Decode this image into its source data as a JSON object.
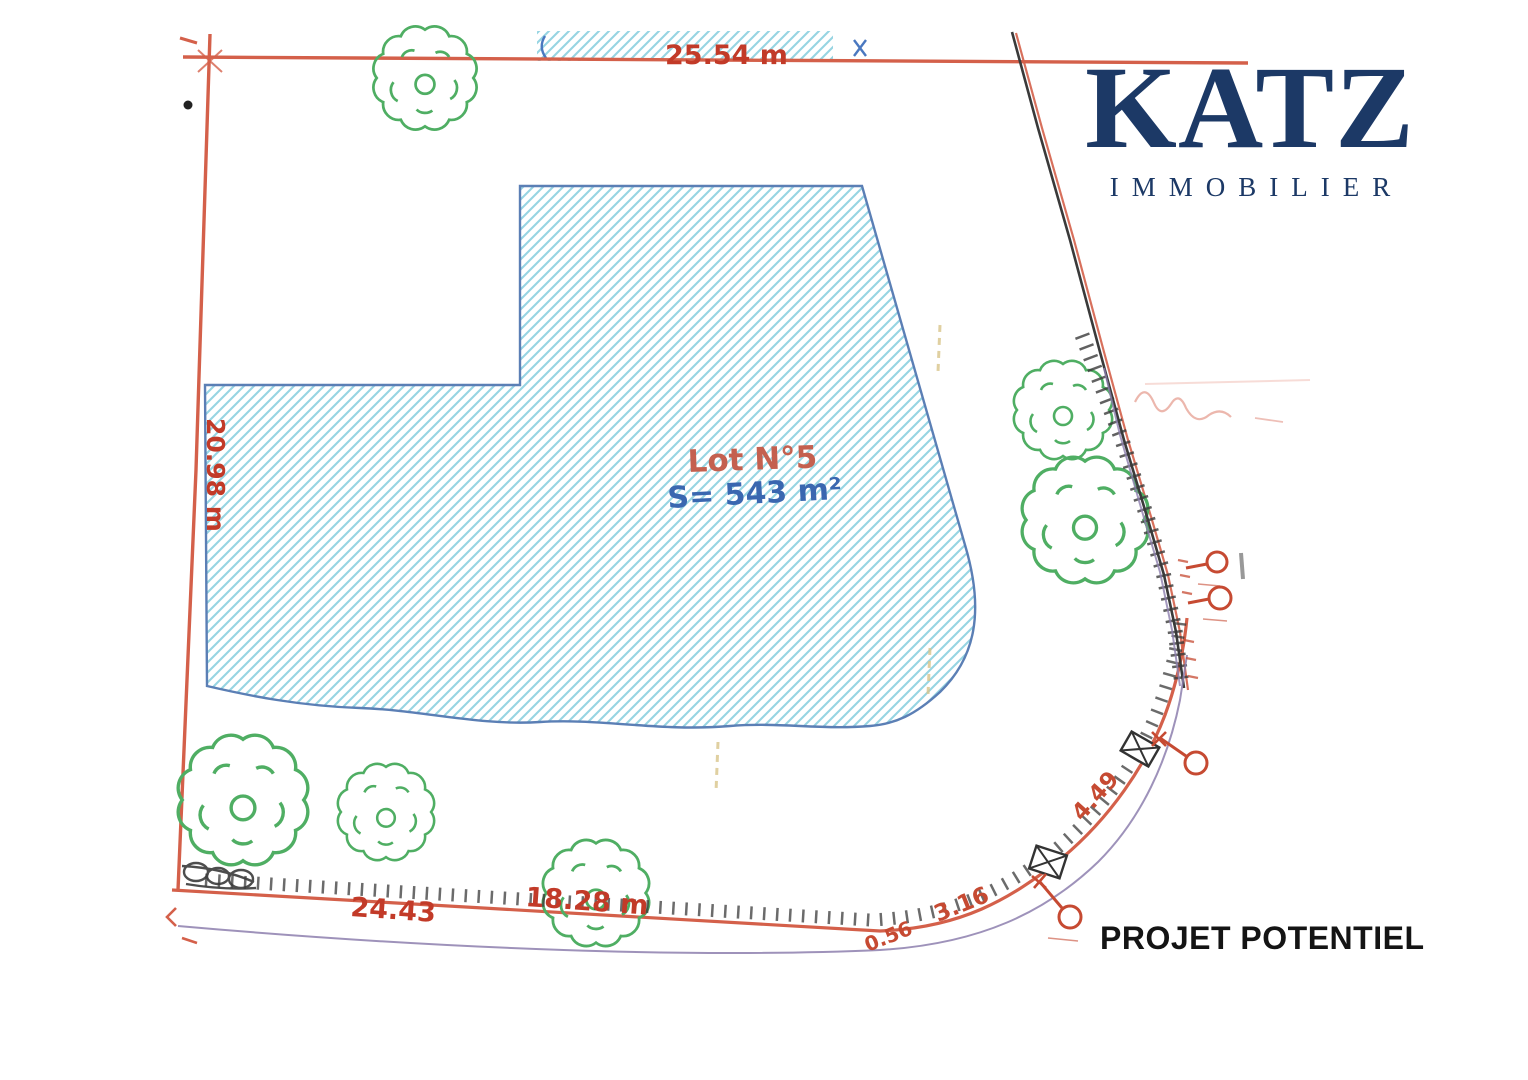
{
  "branding": {
    "logo_text": "KATZ",
    "logo_subtext": "IMMOBILIER",
    "tagline": "PROJET POTENTIEL",
    "logo_color": "#1c3966",
    "tagline_color": "#141414"
  },
  "plan": {
    "lot_label": "Lot N°5",
    "lot_area": "S= 543 m²",
    "measurements": {
      "top": "25.54 m",
      "left": "20.98 m",
      "bottom_1": "24.43",
      "bottom_2": "18.28 m",
      "curve_1": "4.49",
      "curve_2": "3.16",
      "curve_3": "0.56"
    },
    "colors": {
      "boundary_red": "#d4604a",
      "dimension_red": "#c23a28",
      "hatch_blue": "#96d4e2",
      "lot_outline_blue": "#5b7fb5",
      "area_text_blue": "#3a67b0",
      "tree_green": "#4fae63",
      "road_purple": "#8d7fae",
      "survey_black": "#3a3a3a"
    }
  }
}
